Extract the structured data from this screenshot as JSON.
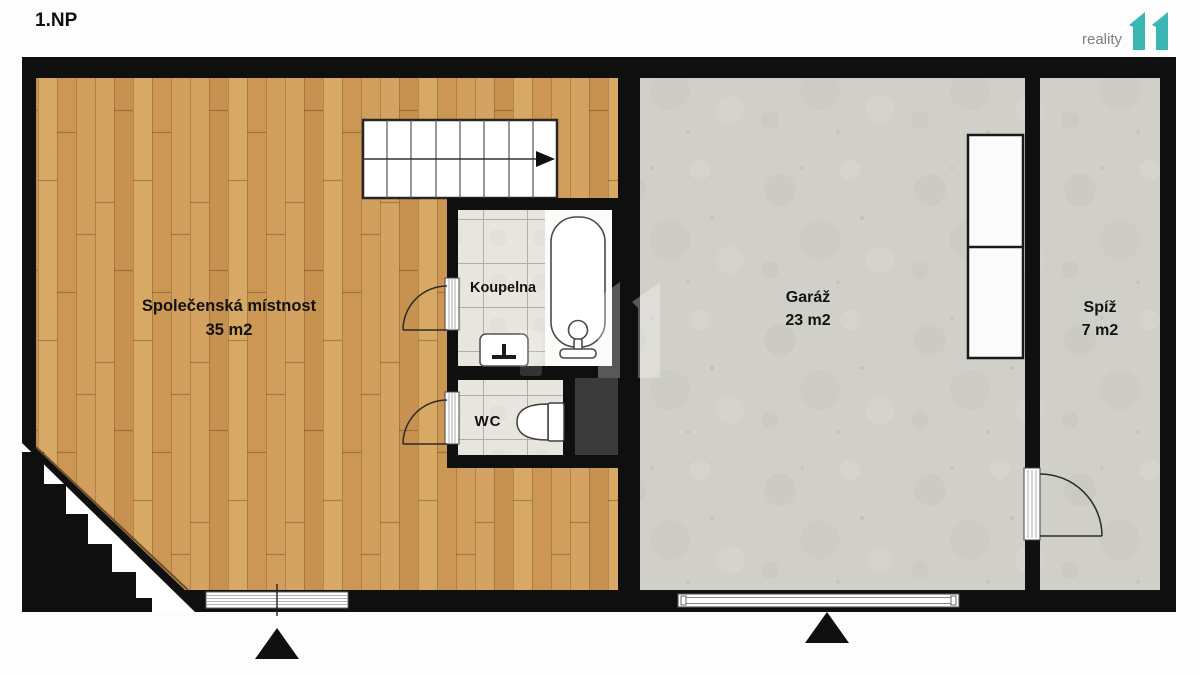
{
  "page": {
    "title": "1.NP"
  },
  "logo": {
    "text": "reality",
    "mark": "11",
    "mark_color": "#3ab7b3",
    "text_color": "#7f7f7f"
  },
  "rooms": {
    "living": {
      "name": "Společenská místnost",
      "area": "35 m2",
      "floor": "wood"
    },
    "bathroom": {
      "name": "Koupelna",
      "floor": "tile"
    },
    "wc": {
      "name": "WC",
      "floor": "tile"
    },
    "garage": {
      "name": "Garáž",
      "area": "23 m2",
      "floor": "concrete"
    },
    "pantry": {
      "name": "Spíž",
      "area": "7 m2",
      "floor": "concrete"
    }
  },
  "markers": {
    "entrance_symbol": "▲",
    "stair_direction_symbol": "►"
  },
  "fixtures": [
    "staircase",
    "bathtub",
    "sink",
    "toilet",
    "shaft",
    "garage-cabinets",
    "door-swings",
    "window",
    "garage-door"
  ],
  "colors": {
    "wall": "#0f0f0f",
    "wood_floor": "#cf9b57",
    "concrete_floor": "#d0cfc8",
    "tile_floor": "#e7e5dd",
    "shaft": "#3b3b3b",
    "accent_teal": "#3ab7b3"
  }
}
